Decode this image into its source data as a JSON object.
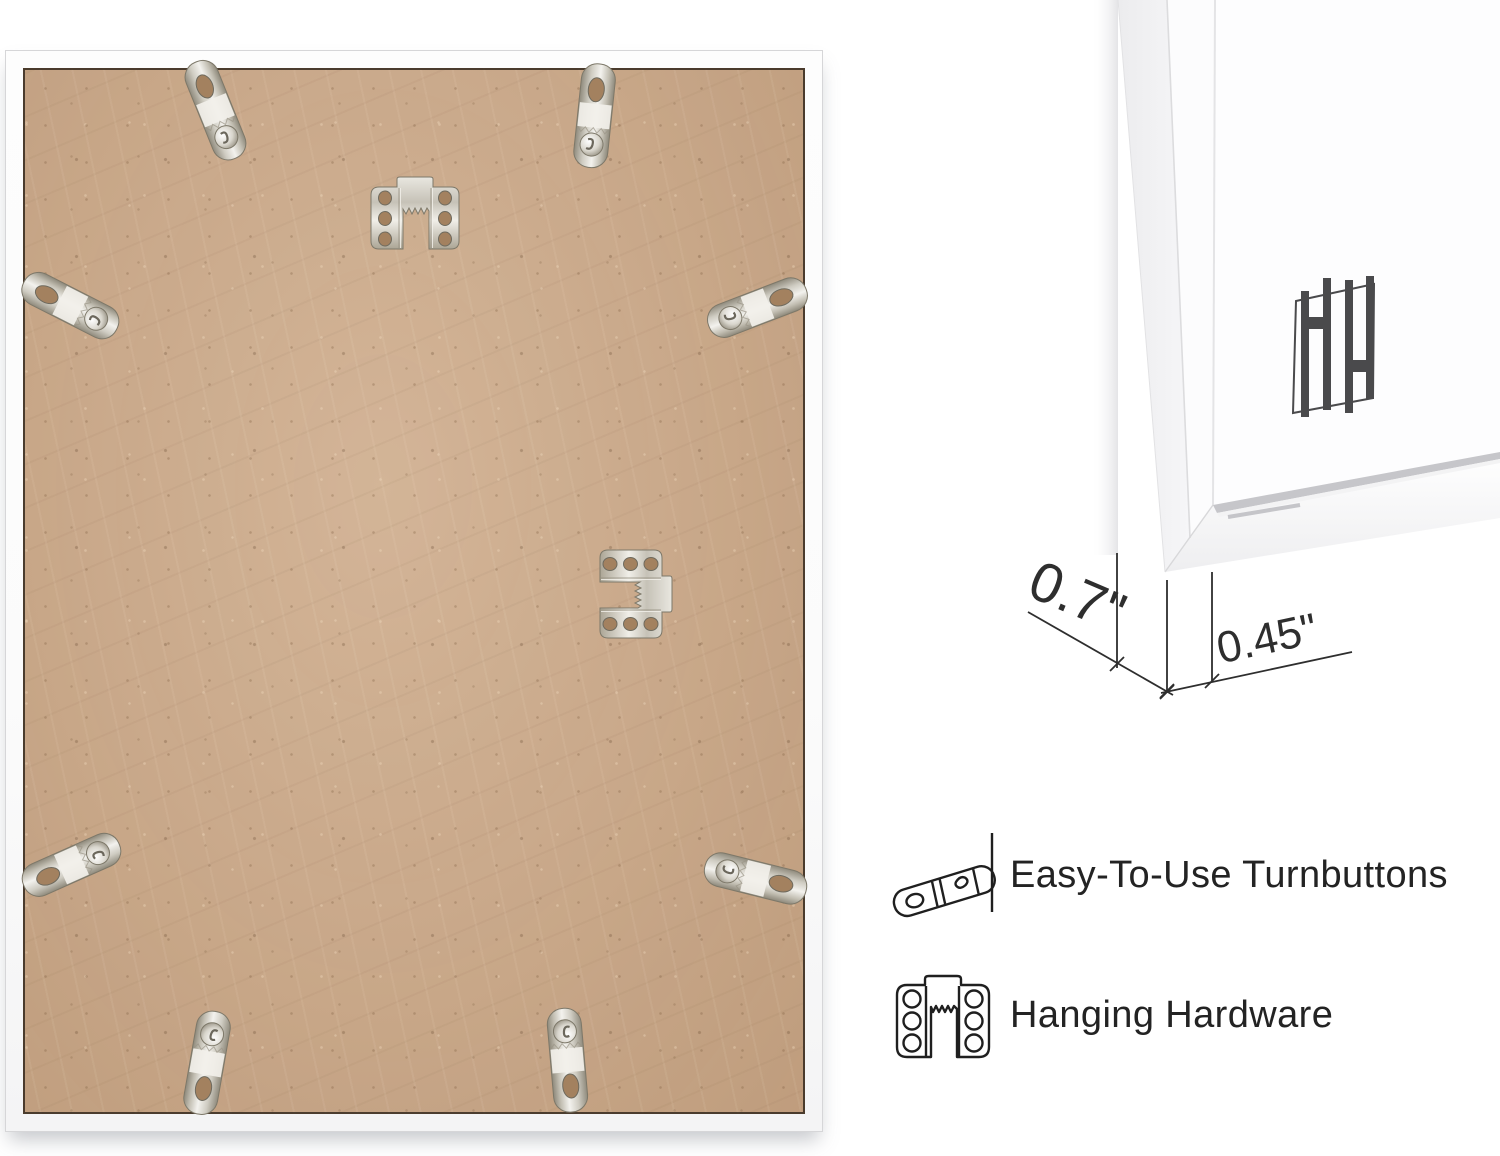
{
  "page": {
    "background": "#ffffff"
  },
  "frame_back_photo": {
    "board_color": "#c8a687",
    "frame_color": "#fcfcfc",
    "hardware": {
      "turnbuttons": 8,
      "sawtooth_hangers": 2
    }
  },
  "corner_photo": {
    "frame_color": "#fbfbfc",
    "logo_mark": "HH-monogram",
    "logo_color": "#4a4a4c"
  },
  "dimensions": {
    "frame_depth": "0.7\"",
    "frame_face_width": "0.45\"",
    "line_color": "#2e2e2e"
  },
  "features": [
    {
      "icon": "turnbutton-icon",
      "label": "Easy-To-Use Turnbuttons"
    },
    {
      "icon": "sawtooth-hanger-icon",
      "label": "Hanging Hardware"
    }
  ],
  "colors": {
    "metal": "#cfccc3",
    "text": "#232323"
  }
}
